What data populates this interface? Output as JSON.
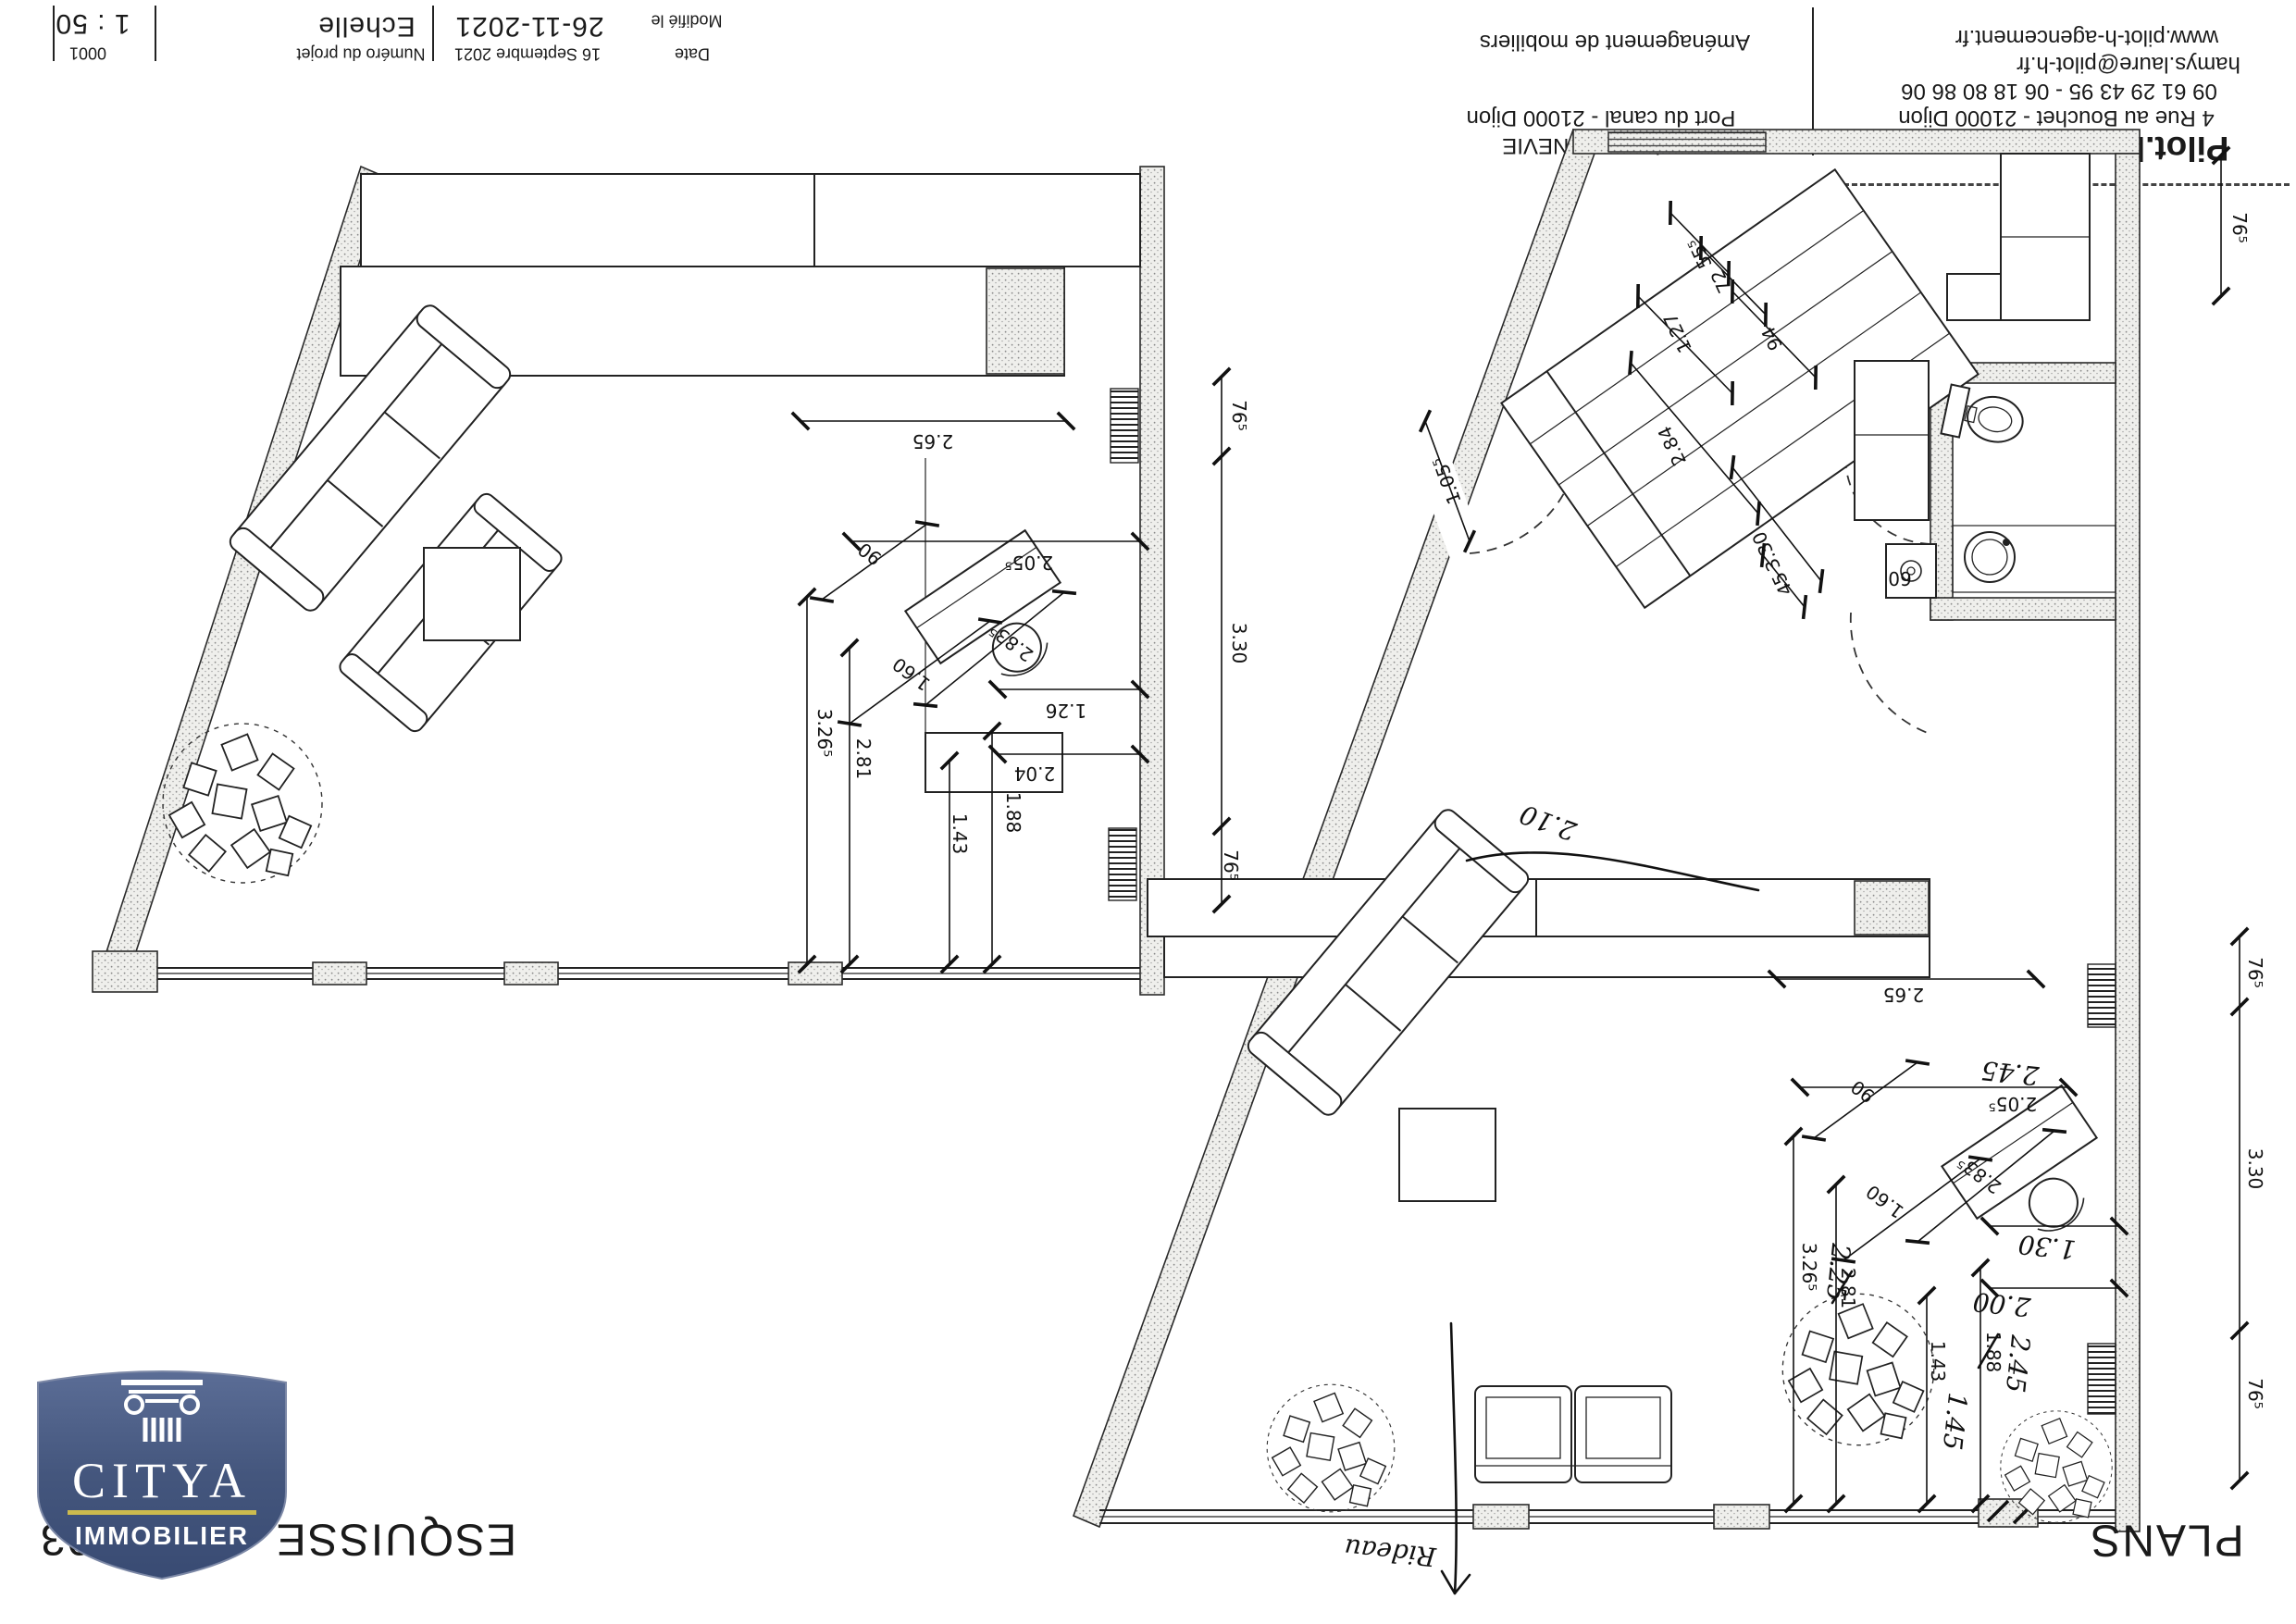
{
  "title_block": {
    "scale_value": "1 : 50",
    "project_number_value": "0001",
    "scale_label": "Echelle",
    "project_number_label": "Numéro du projet",
    "modified_value": "26-11-2021",
    "date_value": "16 Septembre 2021",
    "modified_label": "Modifié le",
    "date_label": "Date"
  },
  "client_block": {
    "project_type": "Aménagement de mobiliers",
    "client_name": "Monsieur BONNEVIE",
    "client_address": "Port du canal - 21000 Dijon"
  },
  "agency_block": {
    "website": "www.pilot-h-agencement.fr",
    "email": "hamys.laure@pilot-h.fr",
    "phones": "09 61 29 43 95 - 06 18 80 86 06",
    "address": "4 Rue au Bouchet - 21000 Dijon",
    "name": "Pilot.h"
  },
  "footer": {
    "sheet_title": "ESQUISSE - PLAN 03",
    "plans_label": "PLANS"
  },
  "logo": {
    "brand": "CITYA",
    "division": "IMMOBILIER",
    "bg_color": "#44567d",
    "accent_color": "#cdbb4e"
  },
  "plans": {
    "left": {
      "dims": [
        "2.65",
        "76⁵",
        "3.30",
        "76⁵",
        "2.05⁵",
        "90",
        "2.83⁵",
        "1.60",
        "1.26",
        "2.04",
        "3.26⁵",
        "2.81",
        "1.88",
        "1.43"
      ]
    },
    "right": {
      "dims": [
        "55⁵",
        "72",
        "1.27",
        "94",
        "2.84",
        "3.30",
        "45",
        "60",
        "1.05⁵",
        "76⁵",
        "2.65",
        "2.05⁵",
        "90",
        "2.83⁵",
        "1.60",
        "3.26⁵",
        "2.81",
        "1.88",
        "1.43",
        "76⁵",
        "3.30",
        "76⁵"
      ],
      "handwritten": [
        "2.45",
        "1.30",
        "2.25",
        "2.00",
        "2.45",
        "1.45",
        "2.10",
        "Rideau"
      ]
    }
  }
}
